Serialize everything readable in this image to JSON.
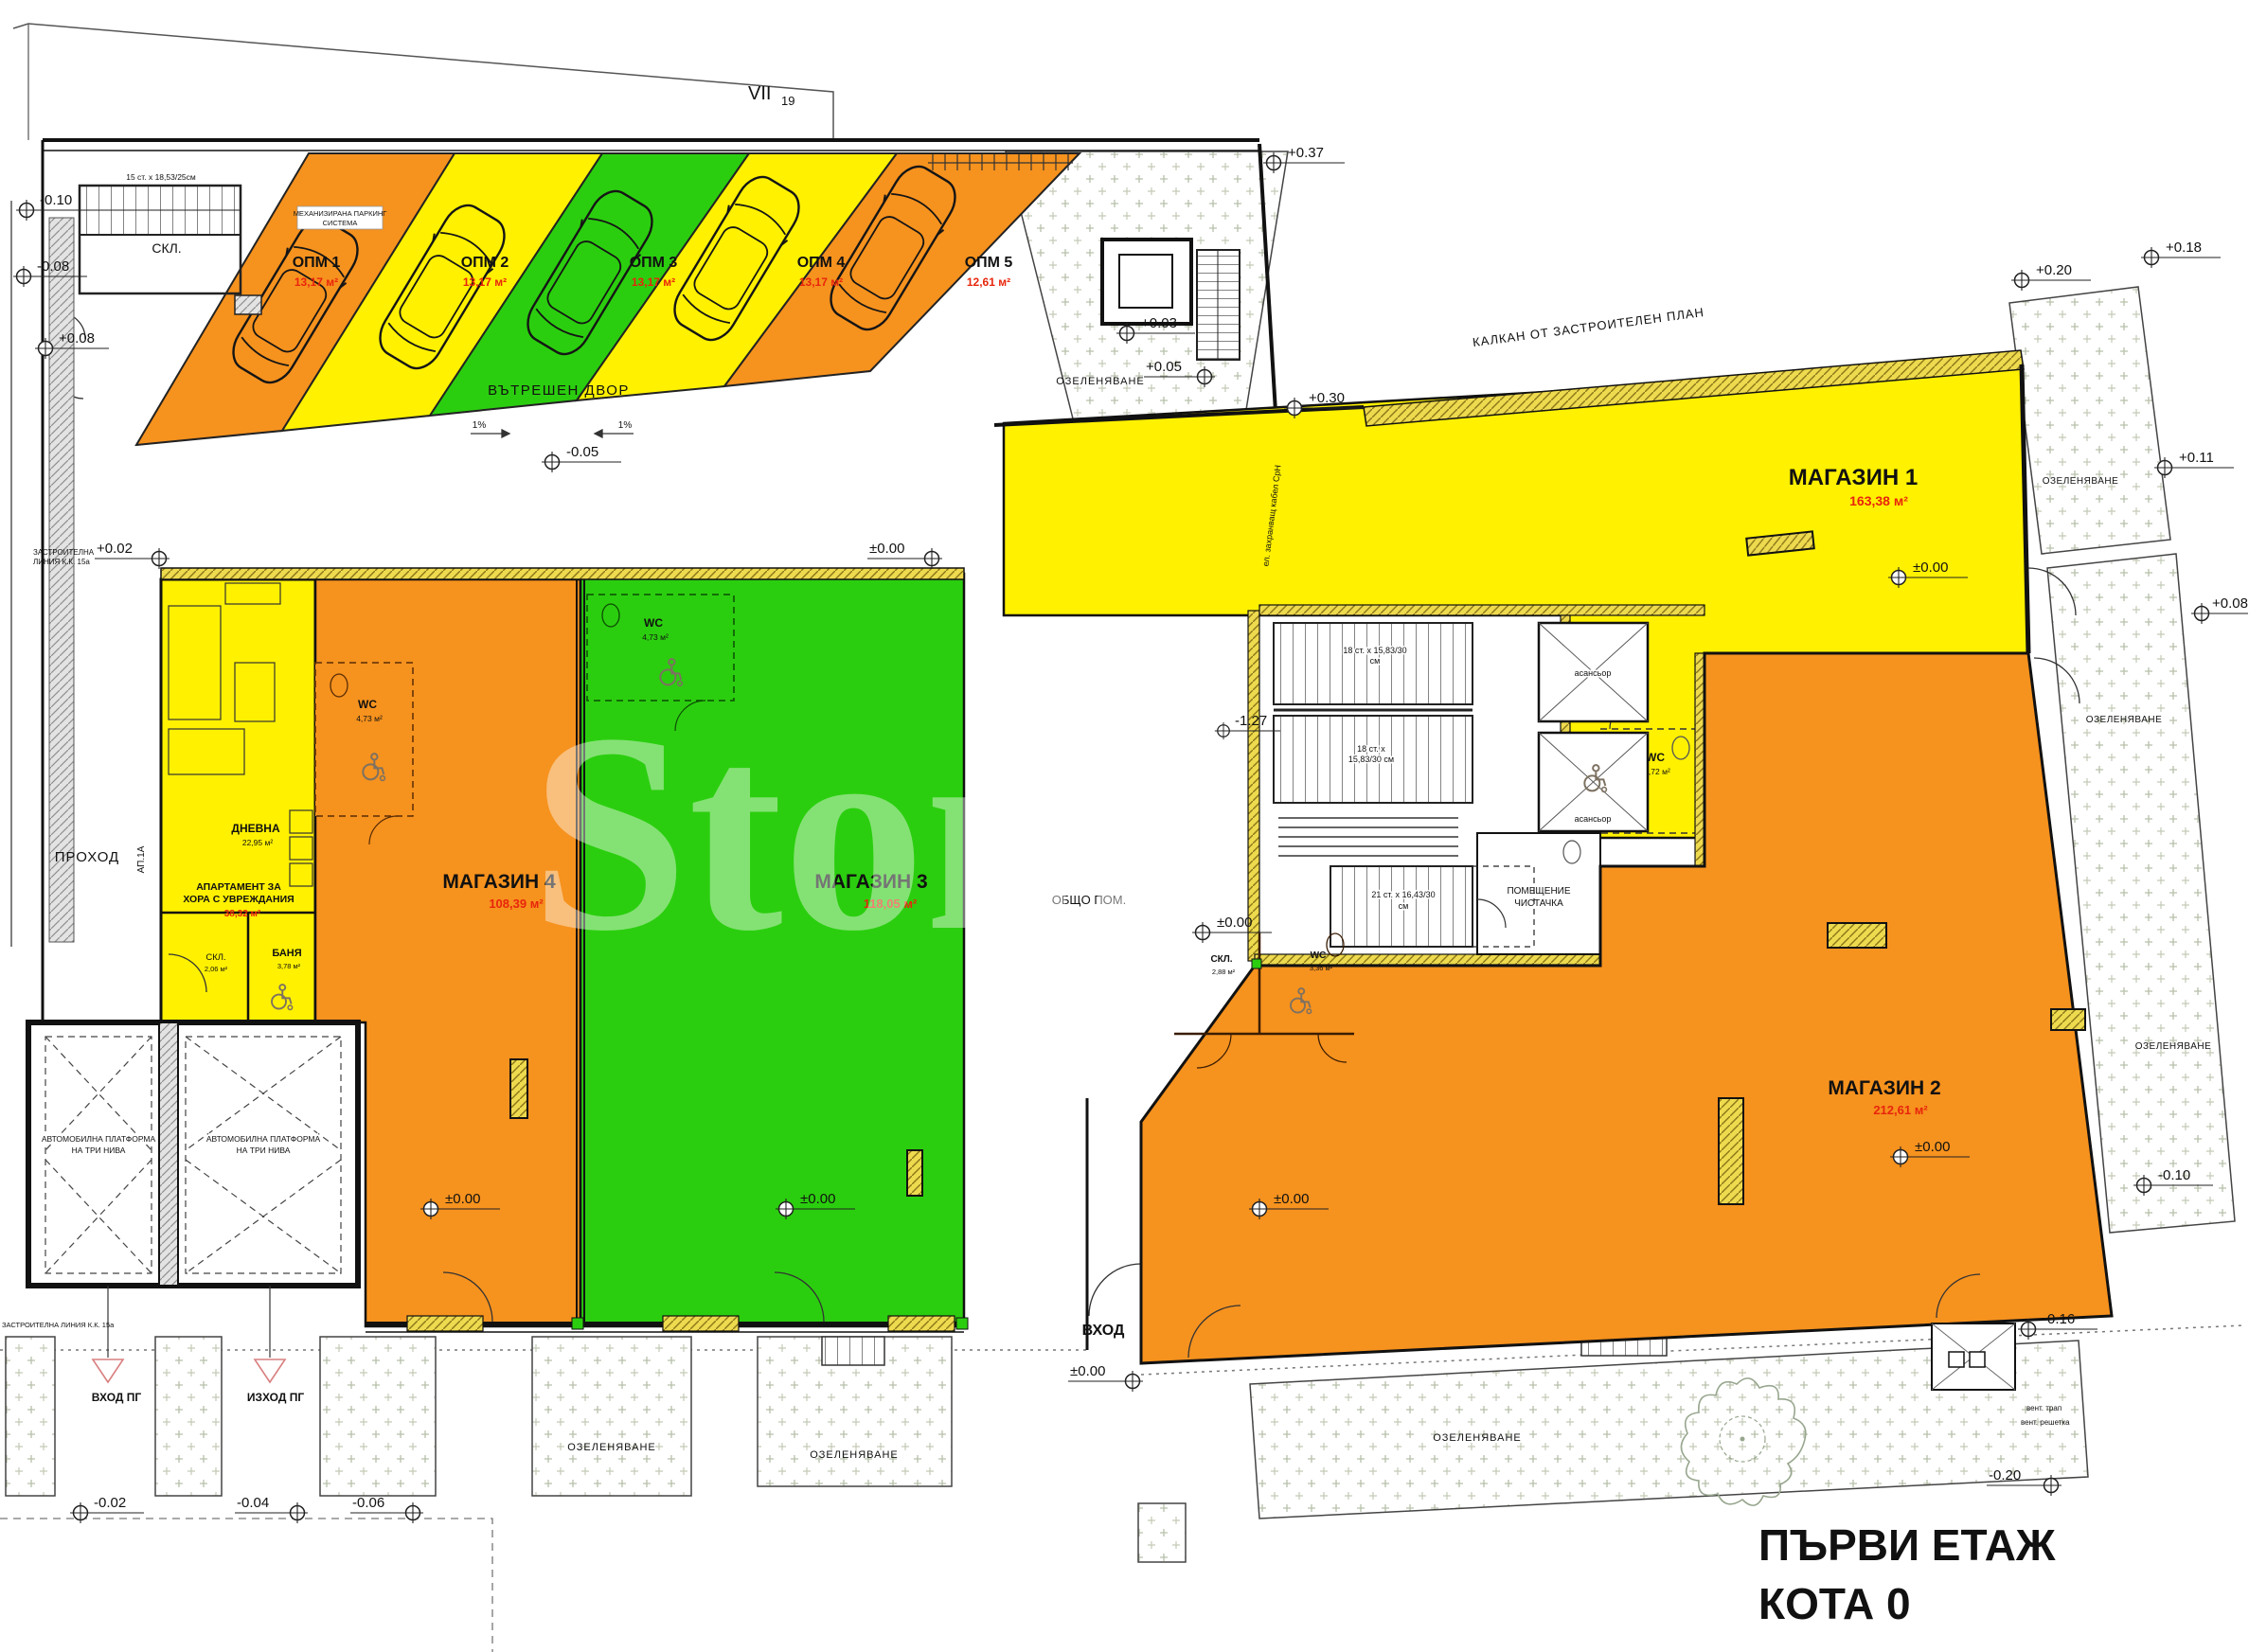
{
  "page": {
    "title_line1": "ПЪРВИ ЕТАЖ",
    "title_line2": "КОТА 0",
    "sheet": "VII",
    "sheet_sub": "19",
    "watermark": "Stone"
  },
  "stores": {
    "m1": {
      "name": "МАГАЗИН 1",
      "area": "163,38 м²"
    },
    "m2": {
      "name": "МАГАЗИН 2",
      "area": "212,61 м²"
    },
    "m3": {
      "name": "МАГАЗИН 3",
      "area": "118,05 м²"
    },
    "m4": {
      "name": "МАГАЗИН 4",
      "area": "108,39 м²"
    }
  },
  "apartment": {
    "l1": "АПАРТАМЕНТ ЗА",
    "l2": "ХОРА С УВРЕЖДАНИЯ",
    "area": "38,32 м²",
    "dnevna": "ДНЕВНА",
    "dnevna_area": "22,95 м²",
    "banya": "БАНЯ",
    "banya_area": "3,78 м²",
    "skl": "СКЛ.",
    "skl_area": "2,06 м²",
    "ap": "АП.1А"
  },
  "rooms": {
    "wc": "WC",
    "wc4_area": "4,73 м²",
    "wc_core_area": "3,72 м²",
    "wc_m2_area": "3,36 м²",
    "skl": "СКЛ.",
    "skl_m2_area": "2,88 м²",
    "obsho": "ОБЩО ПОМ.",
    "chist1": "ПОМЕЩЕНИЕ",
    "chist2": "ЧИСТАЧКА",
    "elevator": "асансьор"
  },
  "labels": {
    "prohod": "ПРОХОД",
    "vhod": "ВХОД",
    "vhod_pg": "ВХОД ПГ",
    "izhod_pg": "ИЗХОД ПГ",
    "court": "ВЪТРЕШЕН ДВОР",
    "landscape": "ОЗЕЛЕНЯВАНЕ",
    "kalkan": "КАЛКАН ОТ ЗАСТРОИТЕЛЕН ПЛАН",
    "plat1": "АВТОМОБИЛНА ПЛАТФОРМА",
    "plat2": "НА ТРИ НИВА",
    "skl_top": "СКЛ.",
    "mech1": "МЕХАНИЗИРАНА ПАРКИНГ",
    "mech2": "СИСТЕМА",
    "slope": "1%",
    "cable": "ел. захранващ кабел СрН",
    "zline1": "ЗАСТРОИТЕЛНА",
    "zline2": "ЛИНИЯ К.К. 15а",
    "zline_b": "ЗАСТРОИТЕЛНА ЛИНИЯ К.К. 15а",
    "vent1": "вент. трап",
    "vent2": "вент. решетка"
  },
  "stairs": {
    "top": "15 ст. x 18,53/25см",
    "s1a": "18 ст. x 15,83/30",
    "s1b": "см",
    "s2a": "18 ст. x",
    "s2b": "15,83/30 см",
    "s3a": "21 ст. x 16,43/30",
    "s3b": "см"
  },
  "parking": [
    {
      "name": "ОПМ 1",
      "area": "13,17 м²"
    },
    {
      "name": "ОПМ 2",
      "area": "13,17 м²"
    },
    {
      "name": "ОПМ 3",
      "area": "13,17 м²"
    },
    {
      "name": "ОПМ 4",
      "area": "13,17 м²"
    },
    {
      "name": "ОПМ 5",
      "area": "12,61 м²"
    }
  ],
  "levels": {
    "p037": "+0.37",
    "p030": "+0.30",
    "p020": "+0.20",
    "p018": "+0.18",
    "p011": "+0.11",
    "p008": "+0.08",
    "p005": "+0.05",
    "p003": "+0.03",
    "p002": "+0.02",
    "zero": "±0.00",
    "n002": "-0.02",
    "n004": "-0.04",
    "n005": "-0.05",
    "n006": "-0.06",
    "n008": "-0.08",
    "n010": "-0.10",
    "n016": "-0.16",
    "n020": "-0.20",
    "n127": "-1.27"
  },
  "colors": {
    "orange": "#F6921E",
    "yellow": "#FFF100",
    "green": "#2BCE0F",
    "red": "#E8250C",
    "blue": "#3FA9F5"
  }
}
